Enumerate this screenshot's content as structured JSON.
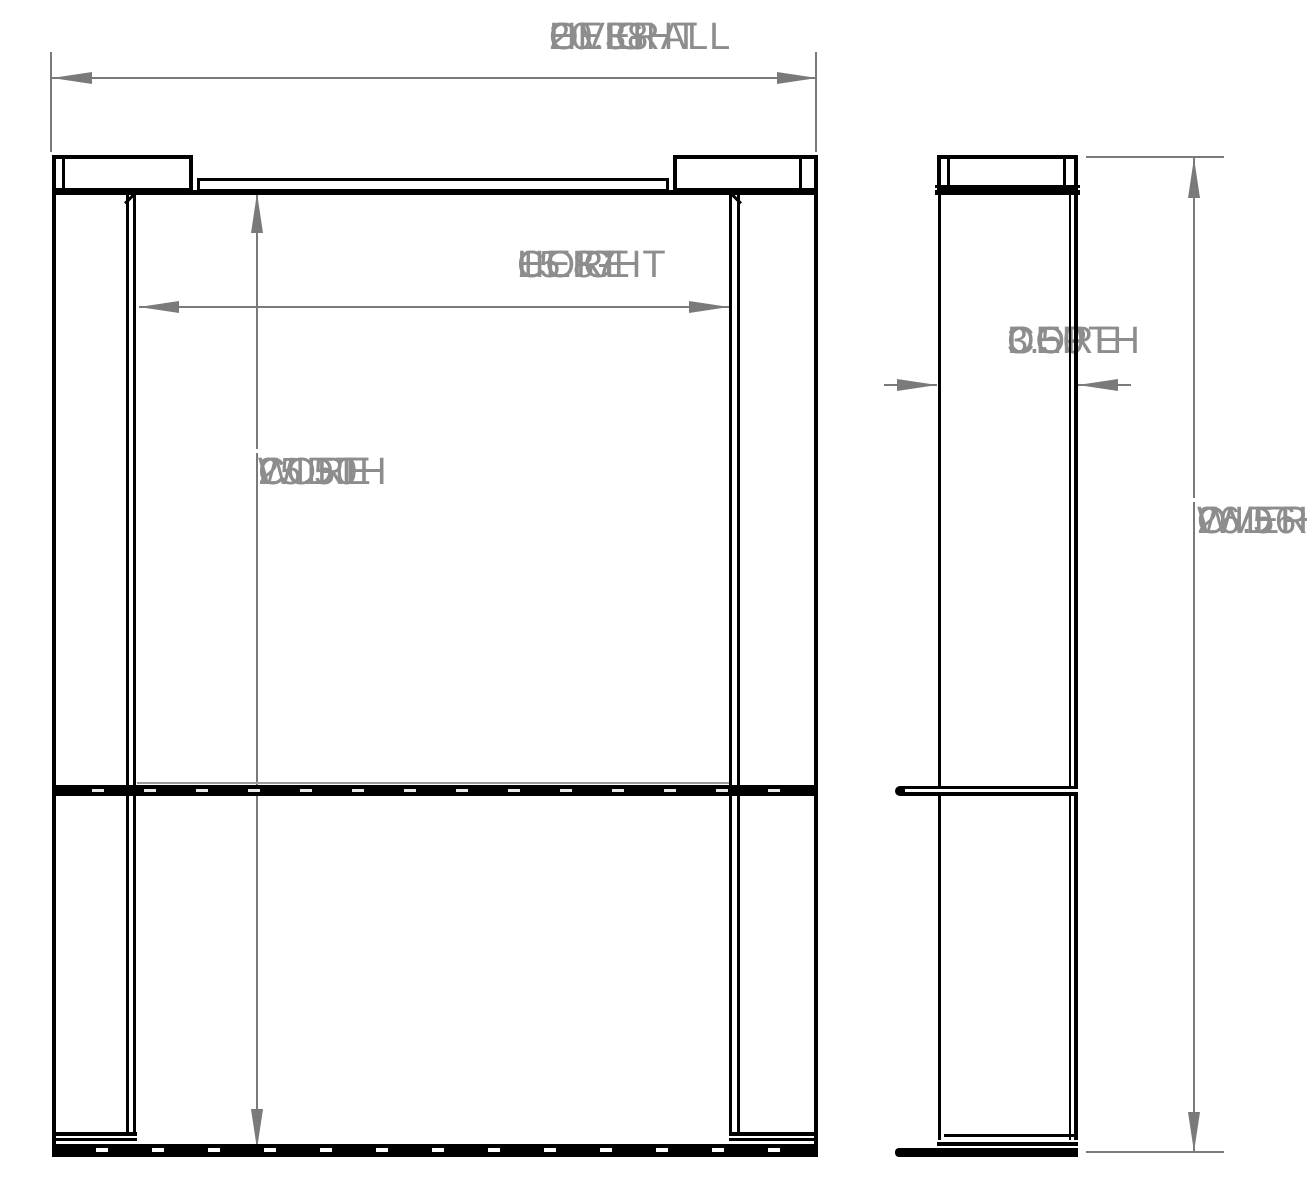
{
  "dimensions": {
    "overall_height": {
      "value": "20.38",
      "label": "OVERALL HEIGHT",
      "lines": [
        "20.38",
        "OVERALL",
        "HEIGHT"
      ]
    },
    "core_height": {
      "value": "15.87",
      "label": "CORE HEIGHT",
      "lines": [
        "15.87",
        "CORE",
        "HEIGHT"
      ]
    },
    "core_width": {
      "value": "25.50",
      "label": "CORE WIDTH",
      "lines": [
        "25.50",
        "CORE",
        "WIDTH"
      ]
    },
    "core_depth": {
      "value": "3.50",
      "label": "CORE DEPTH",
      "lines": [
        "3.50",
        "CORE",
        "DEPTH"
      ]
    },
    "overall_width": {
      "value": "26.56",
      "label": "OVERALL WIDTH",
      "lines": [
        "26.56",
        "OVERALL",
        "WIDTH"
      ]
    }
  },
  "colors": {
    "part_line": "#000000",
    "dimension_line": "#7a7a7a",
    "dimension_text": "#8d8d8d",
    "background": "#ffffff"
  }
}
